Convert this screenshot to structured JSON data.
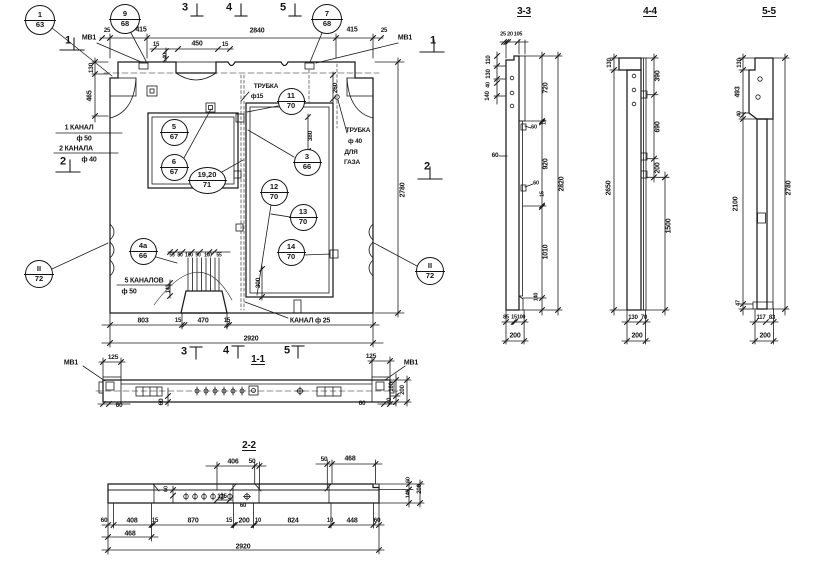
{
  "drawing": {
    "type": "precast concrete wall panel working drawing",
    "views": [
      "план панели",
      "1-1",
      "2-2",
      "3-3",
      "4-4",
      "5-5"
    ],
    "ink_color": "#1a1a1a",
    "paper_color": "#ffffff"
  },
  "labels": [
    {
      "n": "sec-mark-1-left",
      "t": "1",
      "x": 68,
      "y": 41,
      "fs": 11
    },
    {
      "n": "label-mv1-top-left",
      "t": "МВ1",
      "x": 89,
      "y": 38
    },
    {
      "n": "dim-25-top-left",
      "t": "25",
      "x": 107,
      "y": 31,
      "fs": 6
    },
    {
      "n": "dim-415-left",
      "t": "415",
      "x": 141,
      "y": 30
    },
    {
      "n": "dim-2840",
      "t": "2840",
      "x": 257,
      "y": 31
    },
    {
      "n": "dim-415-right",
      "t": "415",
      "x": 352,
      "y": 30
    },
    {
      "n": "dim-25-top-right",
      "t": "25",
      "x": 384,
      "y": 31,
      "fs": 6
    },
    {
      "n": "label-mv1-top-right",
      "t": "МВ1",
      "x": 405,
      "y": 38
    },
    {
      "n": "sec-mark-1-right",
      "t": "1",
      "x": 433,
      "y": 41,
      "fs": 11
    },
    {
      "n": "sec-mark-3-top",
      "t": "3",
      "x": 185,
      "y": 8,
      "fs": 11
    },
    {
      "n": "sec-mark-4-top",
      "t": "4",
      "x": 229,
      "y": 8,
      "fs": 11
    },
    {
      "n": "sec-mark-5-top",
      "t": "5",
      "x": 283,
      "y": 8,
      "fs": 11
    },
    {
      "n": "dim-15-niche-left",
      "t": "15",
      "x": 156,
      "y": 45,
      "fs": 6
    },
    {
      "n": "dim-450",
      "t": "450",
      "x": 197,
      "y": 44
    },
    {
      "n": "dim-15-niche-right",
      "t": "15",
      "x": 225,
      "y": 45,
      "fs": 6
    },
    {
      "n": "dim-40-niche",
      "t": "40",
      "x": 166,
      "y": 56,
      "r": 90,
      "fs": 5.5
    },
    {
      "n": "dim-130-plan-left",
      "t": "130",
      "x": 92,
      "y": 68,
      "r": 90,
      "fs": 6.5
    },
    {
      "n": "dim-465-plan-left",
      "t": "465",
      "x": 90,
      "y": 96,
      "r": 90
    },
    {
      "n": "label-trubka-15",
      "t": "ТРУБКА",
      "x": 266,
      "y": 87,
      "fs": 6.5
    },
    {
      "n": "label-f15",
      "t": "ф15",
      "x": 257,
      "y": 97,
      "fs": 6.5
    },
    {
      "n": "dim-260",
      "t": "260",
      "x": 336,
      "y": 88,
      "r": 90,
      "fs": 6.5
    },
    {
      "n": "label-trubka-40",
      "t": "ТРУБКА",
      "x": 358,
      "y": 131,
      "fs": 6.5
    },
    {
      "n": "label-f40-gas",
      "t": "ф 40",
      "x": 355,
      "y": 142,
      "fs": 6.5
    },
    {
      "n": "label-dlya",
      "t": "ДЛЯ",
      "x": 351,
      "y": 153,
      "fs": 6.5
    },
    {
      "n": "label-gaza",
      "t": "ГАЗА",
      "x": 352,
      "y": 163,
      "fs": 6.5
    },
    {
      "n": "dim-380",
      "t": "380",
      "x": 311,
      "y": 136,
      "r": 90,
      "fs": 6.5
    },
    {
      "n": "label-1-kanal",
      "t": "1 КАНАЛ",
      "x": 79,
      "y": 128
    },
    {
      "n": "label-f50",
      "t": "ф 50",
      "x": 84,
      "y": 139
    },
    {
      "n": "label-2-kanala",
      "t": "2 КАНАЛА",
      "x": 76,
      "y": 149
    },
    {
      "n": "label-f40",
      "t": "ф 40",
      "x": 89,
      "y": 160
    },
    {
      "n": "sec-mark-2-left",
      "t": "2",
      "x": 63,
      "y": 162,
      "fs": 11
    },
    {
      "n": "sec-mark-2-right",
      "t": "2",
      "x": 427,
      "y": 167,
      "fs": 11
    },
    {
      "n": "dim-2780-plan",
      "t": "2780",
      "x": 403,
      "y": 190,
      "r": 90
    },
    {
      "n": "label-5-kanalov",
      "t": "5 КАНАЛОВ",
      "x": 144,
      "y": 281
    },
    {
      "n": "label-f50-bottom",
      "t": "ф 50",
      "x": 129,
      "y": 292
    },
    {
      "n": "dim-140-plan",
      "t": "140",
      "x": 169,
      "y": 289,
      "r": 90,
      "fs": 5.5
    },
    {
      "n": "dim-ch-55a",
      "t": "55",
      "x": 172,
      "y": 256,
      "fs": 5
    },
    {
      "n": "dim-ch-80",
      "t": "80",
      "x": 180,
      "y": 256,
      "fs": 5
    },
    {
      "n": "dim-ch-100a",
      "t": "100",
      "x": 189,
      "y": 256,
      "fs": 5
    },
    {
      "n": "dim-ch-90",
      "t": "90",
      "x": 198,
      "y": 256,
      "fs": 5
    },
    {
      "n": "dim-ch-100b",
      "t": "100",
      "x": 208,
      "y": 256,
      "fs": 5
    },
    {
      "n": "dim-ch-55b",
      "t": "55",
      "x": 219,
      "y": 256,
      "fs": 5
    },
    {
      "n": "dim-300",
      "t": "300",
      "x": 259,
      "y": 283,
      "r": 90,
      "fs": 6.5
    },
    {
      "n": "dim-803",
      "t": "803",
      "x": 143,
      "y": 321
    },
    {
      "n": "dim-15-plan-b1",
      "t": "15",
      "x": 178,
      "y": 321,
      "fs": 6
    },
    {
      "n": "dim-470",
      "t": "470",
      "x": 203,
      "y": 321
    },
    {
      "n": "dim-15-plan-b2",
      "t": "15",
      "x": 227,
      "y": 321,
      "fs": 6
    },
    {
      "n": "label-kanal-25",
      "t": "КАНАЛ  ф 25",
      "x": 310,
      "y": 321
    },
    {
      "n": "dim-2920-plan",
      "t": "2920",
      "x": 251,
      "y": 339
    },
    {
      "n": "sec-mark-3-bottom",
      "t": "3",
      "x": 184,
      "y": 352,
      "fs": 11
    },
    {
      "n": "sec-mark-4-bottom",
      "t": "4",
      "x": 226,
      "y": 351,
      "fs": 11
    },
    {
      "n": "sec-mark-5-bottom",
      "t": "5",
      "x": 287,
      "y": 351,
      "fs": 11
    },
    {
      "n": "title-section-1-1",
      "t": "1-1",
      "x": 258,
      "y": 360,
      "fs": 10,
      "u": 1
    },
    {
      "n": "label-mv1-11-left",
      "t": "МВ1",
      "x": 71,
      "y": 363
    },
    {
      "n": "dim-125-11-left",
      "t": "125",
      "x": 113,
      "y": 358,
      "fs": 6.5
    },
    {
      "n": "dim-125-11-right",
      "t": "125",
      "x": 371,
      "y": 357,
      "fs": 6.5
    },
    {
      "n": "label-mv1-11-right",
      "t": "МВ1",
      "x": 411,
      "y": 363
    },
    {
      "n": "dim-60-11-left",
      "t": "60",
      "x": 119,
      "y": 406,
      "fs": 6.5
    },
    {
      "n": "dim-60-11-mid",
      "t": "60",
      "x": 162,
      "y": 402,
      "r": 90,
      "fs": 6.5
    },
    {
      "n": "dim-60-11-right",
      "t": "60",
      "x": 362,
      "y": 404,
      "fs": 6.5
    },
    {
      "n": "dim-160-11",
      "t": "160",
      "x": 392,
      "y": 387,
      "r": 90,
      "fs": 6
    },
    {
      "n": "dim-200-11",
      "t": "200",
      "x": 403,
      "y": 390,
      "r": 90,
      "fs": 6
    },
    {
      "n": "dim-40-11",
      "t": "40",
      "x": 390,
      "y": 401,
      "r": 90,
      "fs": 6
    },
    {
      "n": "title-section-2-2",
      "t": "2-2",
      "x": 249,
      "y": 446,
      "fs": 10,
      "u": 1
    },
    {
      "n": "dim-406",
      "t": "406",
      "x": 233,
      "y": 462
    },
    {
      "n": "dim-50-22a",
      "t": "50",
      "x": 252,
      "y": 462,
      "fs": 6.5
    },
    {
      "n": "dim-50-22b",
      "t": "50",
      "x": 324,
      "y": 460,
      "fs": 6.5
    },
    {
      "n": "dim-468-top",
      "t": "468",
      "x": 350,
      "y": 459
    },
    {
      "n": "dim-60-22-in",
      "t": "60",
      "x": 167,
      "y": 489,
      "r": 90,
      "fs": 5.5
    },
    {
      "n": "dim-135",
      "t": "135",
      "x": 222,
      "y": 497,
      "fs": 6
    },
    {
      "n": "dim-60-22-b",
      "t": "60",
      "x": 243,
      "y": 506,
      "fs": 6
    },
    {
      "n": "dim-60-22-v",
      "t": "60",
      "x": 409,
      "y": 480,
      "r": 90,
      "fs": 5.5
    },
    {
      "n": "dim-140-22-v",
      "t": "140",
      "x": 409,
      "y": 494,
      "r": 90,
      "fs": 5.5
    },
    {
      "n": "dim-200-22-v",
      "t": "200",
      "x": 420,
      "y": 489,
      "r": 90,
      "fs": 6
    },
    {
      "n": "dim-60-22-1",
      "t": "60",
      "x": 104,
      "y": 521,
      "fs": 6.5
    },
    {
      "n": "dim-408",
      "t": "408",
      "x": 132,
      "y": 521
    },
    {
      "n": "dim-15-22a",
      "t": "15",
      "x": 155,
      "y": 521,
      "fs": 6
    },
    {
      "n": "dim-870",
      "t": "870",
      "x": 193,
      "y": 521
    },
    {
      "n": "dim-15-22b",
      "t": "15",
      "x": 229,
      "y": 521,
      "fs": 6
    },
    {
      "n": "dim-200-22",
      "t": "200",
      "x": 244,
      "y": 521
    },
    {
      "n": "dim-10-22a",
      "t": "10",
      "x": 258,
      "y": 521,
      "fs": 6
    },
    {
      "n": "dim-824",
      "t": "824",
      "x": 293,
      "y": 521
    },
    {
      "n": "dim-10-22b",
      "t": "10",
      "x": 330,
      "y": 521,
      "fs": 6
    },
    {
      "n": "dim-448",
      "t": "448",
      "x": 352,
      "y": 521
    },
    {
      "n": "dim-60-22-2",
      "t": "60",
      "x": 377,
      "y": 521,
      "fs": 6.5
    },
    {
      "n": "dim-468-bottom",
      "t": "468",
      "x": 130,
      "y": 534
    },
    {
      "n": "dim-2920-22",
      "t": "2920",
      "x": 243,
      "y": 547
    },
    {
      "n": "title-section-3-3",
      "t": "3-3",
      "x": 524,
      "y": 12,
      "fs": 10,
      "u": 1
    },
    {
      "n": "dim-25-33",
      "t": "25",
      "x": 503,
      "y": 35,
      "fs": 5.5
    },
    {
      "n": "dim-20-33",
      "t": "20",
      "x": 510,
      "y": 35,
      "fs": 5.5
    },
    {
      "n": "dim-105-33",
      "t": "105",
      "x": 518,
      "y": 35,
      "fs": 5.5
    },
    {
      "n": "dim-110-33",
      "t": "110",
      "x": 489,
      "y": 60,
      "r": 90,
      "fs": 6
    },
    {
      "n": "dim-130-33",
      "t": "130",
      "x": 489,
      "y": 74,
      "r": 90,
      "fs": 6
    },
    {
      "n": "dim-40-33",
      "t": "40",
      "x": 489,
      "y": 85,
      "r": 90,
      "fs": 5.5
    },
    {
      "n": "dim-140-33",
      "t": "140",
      "x": 488,
      "y": 96,
      "r": 90,
      "fs": 6
    },
    {
      "n": "dim-60-33-left",
      "t": "60",
      "x": 495,
      "y": 156,
      "fs": 6.5
    },
    {
      "n": "dim-720",
      "t": "720",
      "x": 546,
      "y": 88,
      "r": 90
    },
    {
      "n": "dim-15-33a",
      "t": "15",
      "x": 545,
      "y": 122,
      "r": 90,
      "fs": 5.5
    },
    {
      "n": "dim-60-33a",
      "t": "60",
      "x": 534,
      "y": 128,
      "fs": 5.5
    },
    {
      "n": "dim-920",
      "t": "920",
      "x": 546,
      "y": 164,
      "r": 90
    },
    {
      "n": "dim-60-33b",
      "t": "60",
      "x": 536,
      "y": 184,
      "fs": 5.5
    },
    {
      "n": "dim-15-33b",
      "t": "15",
      "x": 543,
      "y": 194,
      "r": 90,
      "fs": 5.5
    },
    {
      "n": "dim-1010",
      "t": "1010",
      "x": 546,
      "y": 252,
      "r": 90
    },
    {
      "n": "dim-140-33b",
      "t": "140",
      "x": 537,
      "y": 297,
      "r": 90,
      "fs": 5.5
    },
    {
      "n": "dim-2820",
      "t": "2820",
      "x": 562,
      "y": 184,
      "r": 90
    },
    {
      "n": "dim-85-33",
      "t": "85",
      "x": 506,
      "y": 318,
      "fs": 5.5
    },
    {
      "n": "dim-15-33c",
      "t": "15",
      "x": 514,
      "y": 318,
      "fs": 5.5
    },
    {
      "n": "dim-100-33",
      "t": "100",
      "x": 521,
      "y": 318,
      "fs": 5.5
    },
    {
      "n": "dim-200-33",
      "t": "200",
      "x": 515,
      "y": 336
    },
    {
      "n": "title-section-4-4",
      "t": "4-4",
      "x": 650,
      "y": 12,
      "fs": 10,
      "u": 1
    },
    {
      "n": "dim-130-44",
      "t": "130",
      "x": 610,
      "y": 63,
      "r": 90,
      "fs": 6
    },
    {
      "n": "dim-2650",
      "t": "2650",
      "x": 609,
      "y": 188,
      "r": 90
    },
    {
      "n": "dim-390",
      "t": "390",
      "x": 658,
      "y": 76,
      "r": 90
    },
    {
      "n": "dim-690",
      "t": "690",
      "x": 658,
      "y": 127,
      "r": 90
    },
    {
      "n": "dim-200-44v",
      "t": "200",
      "x": 658,
      "y": 168,
      "r": 90
    },
    {
      "n": "dim-1500",
      "t": "1500",
      "x": 669,
      "y": 226,
      "r": 90
    },
    {
      "n": "dim-130-44b",
      "t": "130",
      "x": 633,
      "y": 318,
      "fs": 6
    },
    {
      "n": "dim-70-44",
      "t": "70",
      "x": 644,
      "y": 318,
      "fs": 6
    },
    {
      "n": "dim-200-44",
      "t": "200",
      "x": 637,
      "y": 336
    },
    {
      "n": "title-section-5-5",
      "t": "5-5",
      "x": 769,
      "y": 12,
      "fs": 10,
      "u": 1
    },
    {
      "n": "dim-130-55",
      "t": "130",
      "x": 740,
      "y": 63,
      "r": 90,
      "fs": 6
    },
    {
      "n": "dim-493",
      "t": "493",
      "x": 738,
      "y": 92,
      "r": 90
    },
    {
      "n": "dim-40-55",
      "t": "40",
      "x": 740,
      "y": 114,
      "r": 90,
      "fs": 5.5
    },
    {
      "n": "dim-2100",
      "t": "2100",
      "x": 736,
      "y": 204,
      "r": 90
    },
    {
      "n": "dim-47",
      "t": "47",
      "x": 739,
      "y": 303,
      "r": 90,
      "fs": 5.5
    },
    {
      "n": "dim-2780-55",
      "t": "2780",
      "x": 789,
      "y": 188,
      "r": 90
    },
    {
      "n": "dim-117",
      "t": "117",
      "x": 761,
      "y": 318,
      "fs": 6
    },
    {
      "n": "dim-83",
      "t": "83",
      "x": 772,
      "y": 318,
      "fs": 6
    },
    {
      "n": "dim-200-55",
      "t": "200",
      "x": 765,
      "y": 336
    }
  ],
  "callouts": [
    {
      "n": "callout-1-63",
      "top": "1",
      "bot": "63",
      "x": 40,
      "y": 20,
      "w": 30,
      "h": 30
    },
    {
      "n": "callout-9-68",
      "top": "9",
      "bot": "68",
      "x": 125,
      "y": 19,
      "w": 30,
      "h": 30
    },
    {
      "n": "callout-7-68",
      "top": "7",
      "bot": "68",
      "x": 327,
      "y": 19,
      "w": 30,
      "h": 30
    },
    {
      "n": "callout-11-70",
      "top": "11",
      "bot": "70",
      "x": 291,
      "y": 101,
      "w": 27,
      "h": 27
    },
    {
      "n": "callout-5-67",
      "top": "5",
      "bot": "67",
      "x": 174,
      "y": 132,
      "w": 27,
      "h": 27
    },
    {
      "n": "callout-6-67",
      "top": "6",
      "bot": "67",
      "x": 174,
      "y": 167,
      "w": 27,
      "h": 27
    },
    {
      "n": "callout-19-20-71",
      "top": "19,20",
      "bot": "71",
      "x": 207,
      "y": 180,
      "w": 37,
      "h": 27
    },
    {
      "n": "callout-3-66",
      "top": "3",
      "bot": "66",
      "x": 307,
      "y": 162,
      "w": 27,
      "h": 27
    },
    {
      "n": "callout-12-70",
      "top": "12",
      "bot": "70",
      "x": 274,
      "y": 192,
      "w": 27,
      "h": 27
    },
    {
      "n": "callout-13-70",
      "top": "13",
      "bot": "70",
      "x": 303,
      "y": 217,
      "w": 27,
      "h": 27
    },
    {
      "n": "callout-14-70",
      "top": "14",
      "bot": "70",
      "x": 291,
      "y": 252,
      "w": 27,
      "h": 27
    },
    {
      "n": "callout-4a-66",
      "top": "4а",
      "bot": "66",
      "x": 143,
      "y": 251,
      "w": 27,
      "h": 27
    },
    {
      "n": "callout-II-72-left",
      "top": "II",
      "bot": "72",
      "x": 39,
      "y": 274,
      "w": 28,
      "h": 28
    },
    {
      "n": "callout-II-72-right",
      "top": "II",
      "bot": "72",
      "x": 430,
      "y": 271,
      "w": 28,
      "h": 28
    }
  ]
}
